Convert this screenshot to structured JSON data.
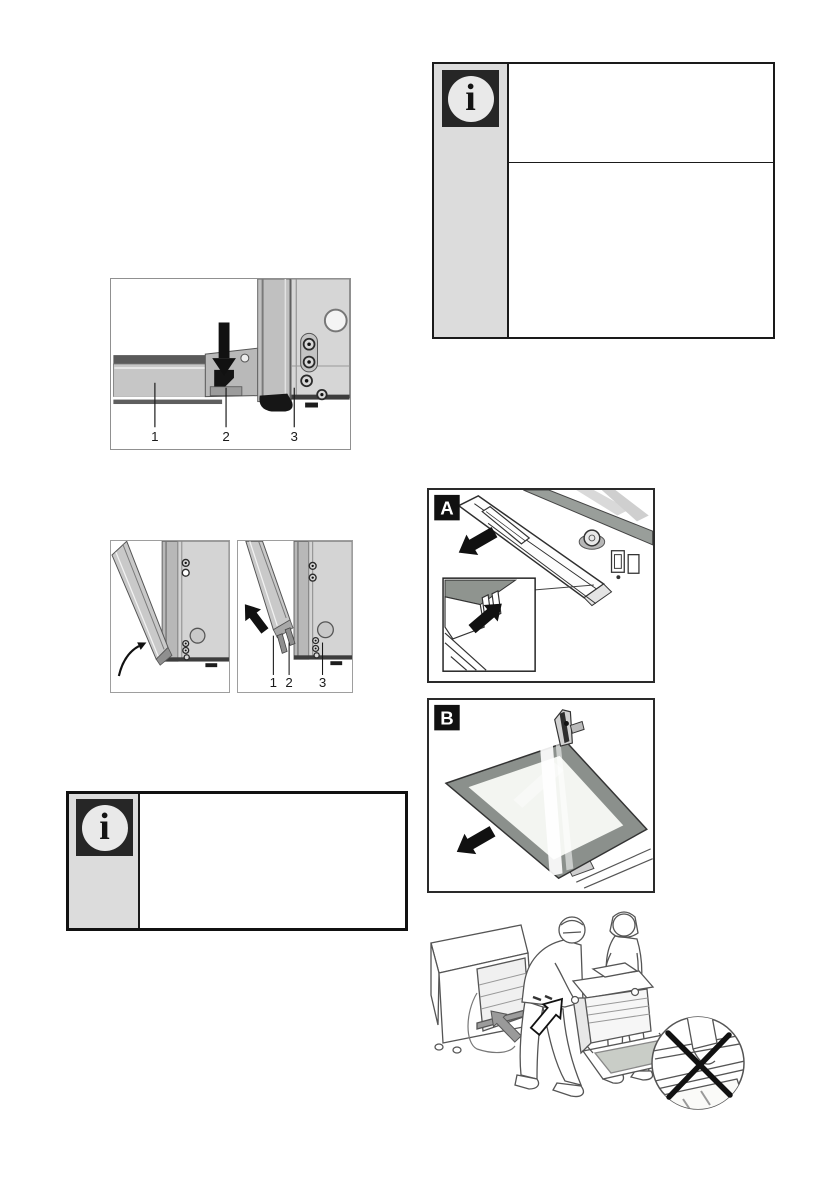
{
  "page": {
    "width": 840,
    "height": 1190,
    "background": "#ffffff"
  },
  "colors": {
    "ink": "#1a1a1a",
    "note_sidebar_bg": "#dcdcdc",
    "icon_square": "#262626",
    "icon_circle": "#e9e9e9",
    "metal_light": "#d6d6d6",
    "metal_mid": "#bdbdbd",
    "metal_dark": "#6e6e6e",
    "glass_frame": "#8b908c",
    "glass_pane": "#f3f5f1"
  },
  "notes": {
    "top": {
      "icon": "info",
      "glyph": "i",
      "section_1_text": "",
      "section_2_text": ""
    },
    "bottom": {
      "icon": "info",
      "glyph": "i",
      "text": ""
    }
  },
  "figures": {
    "hinge_lock": {
      "callouts": [
        "1",
        "2",
        "3"
      ]
    },
    "door_lift": {
      "callouts": [
        "1",
        "2",
        "3"
      ]
    },
    "trim_removal": {
      "label": "A"
    },
    "glass_removal": {
      "label": "B"
    }
  }
}
